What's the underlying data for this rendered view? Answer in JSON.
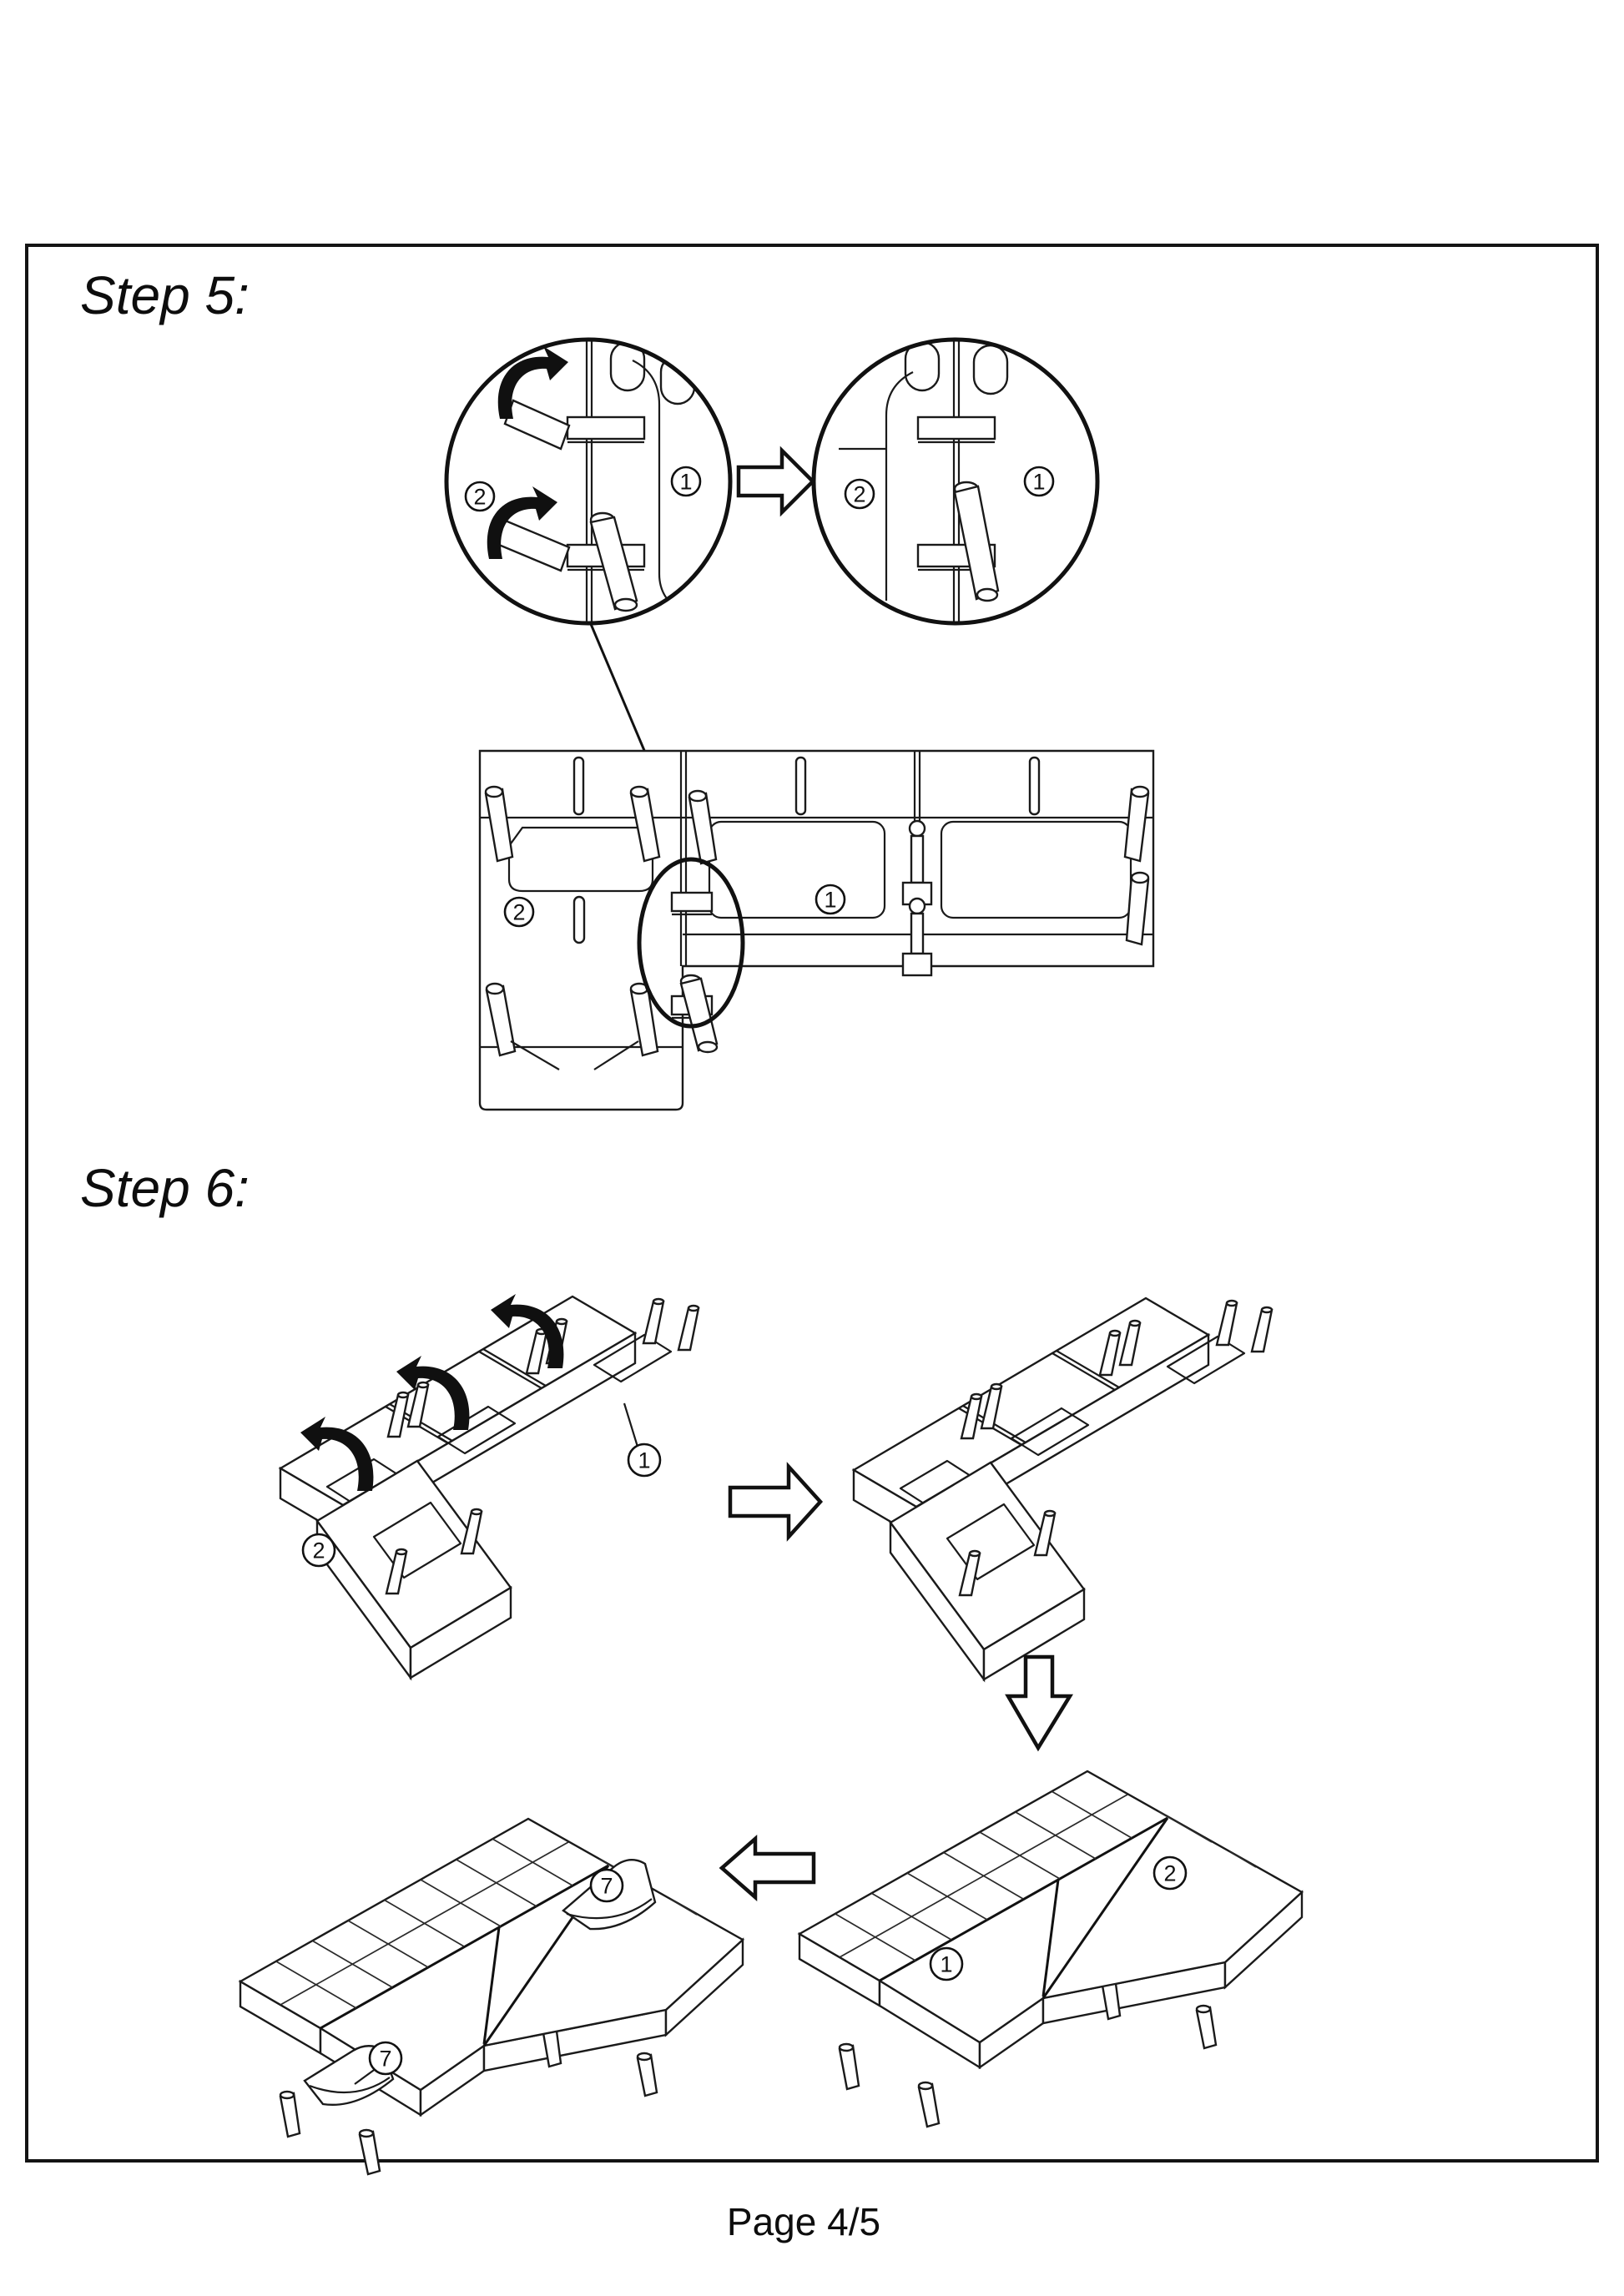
{
  "page": {
    "footer_label": "Page 4/5"
  },
  "step5": {
    "title": "Step 5:",
    "detail_before": {
      "left_part": "2",
      "right_part": "1"
    },
    "detail_after": {
      "left_part": "2",
      "right_part": "1"
    },
    "top_view": {
      "chaise_part": "2",
      "seat_part": "1"
    }
  },
  "step6": {
    "title": "Step 6:",
    "flipped_frame": {
      "seat_part": "1",
      "chaise_part": "2"
    },
    "assembled_sofa": {
      "seat_part": "1",
      "chaise_part": "2"
    },
    "final_sofa": {
      "headrest_right": "7",
      "headrest_left": "7"
    }
  }
}
